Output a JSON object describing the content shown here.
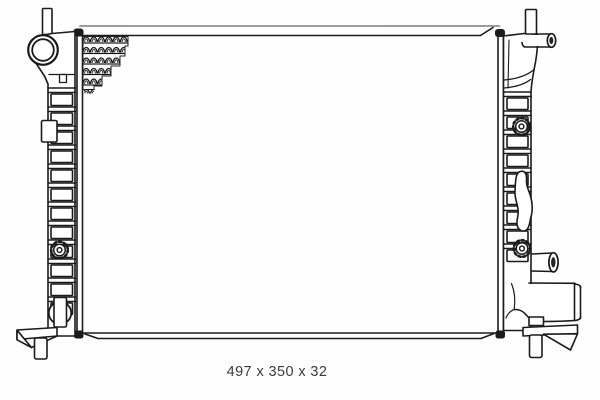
{
  "figure": {
    "kind": "technical line drawing",
    "subject": "radiator front view",
    "caption": "497 x 350 x 32",
    "dimensions": {
      "width_mm": "497",
      "height_mm": "350",
      "depth_mm": "32"
    }
  },
  "colors": {
    "background": "#fefefe",
    "line": "#1b1b1b",
    "line_soft": "#8f8f8f",
    "caption_text": "#3b3b3b"
  }
}
